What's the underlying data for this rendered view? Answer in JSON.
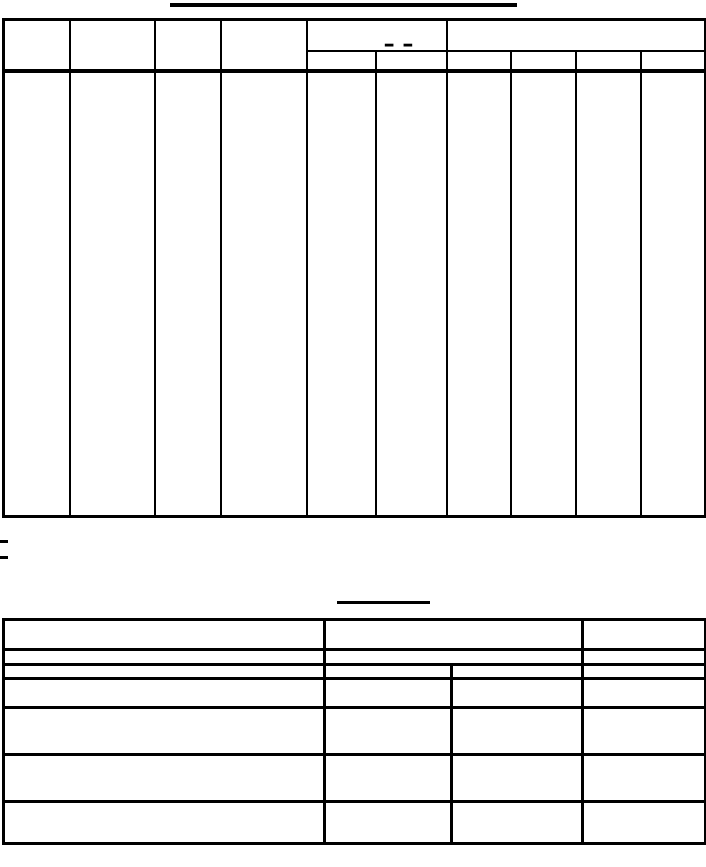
{
  "page": {
    "background_color": "#ffffff",
    "line_color": "#000000",
    "description": "Scanned blank form: two ruled tables with empty cells; titles did not print, only their underlines"
  },
  "upper_table": {
    "merged_header_dashes": "– –"
  }
}
